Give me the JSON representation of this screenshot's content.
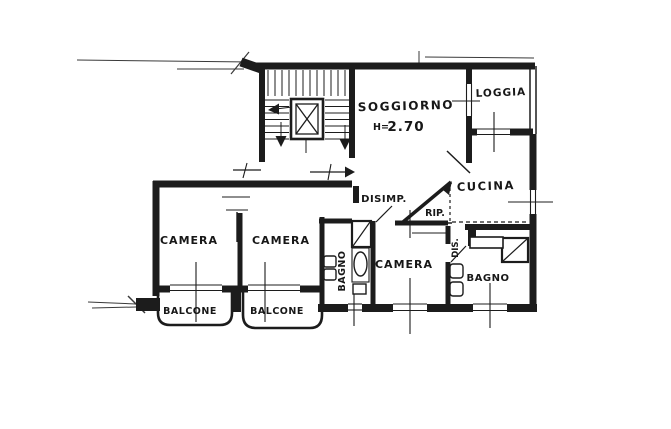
{
  "plan": {
    "type": "apartment-floor-plan",
    "ink_color": "#1c1c1c",
    "paper_color": "#ffffff"
  },
  "rooms": {
    "soggiorno": {
      "label": "SOGGIORNO",
      "height_prefix": "H=",
      "height_value": "2.70"
    },
    "loggia": {
      "label": "LOGGIA"
    },
    "cucina": {
      "label": "CUCINA"
    },
    "disimpegno": {
      "label": "DISIMP."
    },
    "ripostiglio": {
      "label": "RIP."
    },
    "camera_sx": {
      "label": "CAMERA"
    },
    "camera_centro": {
      "label": "CAMERA"
    },
    "camera_dx": {
      "label": "CAMERA"
    },
    "bagno_centro": {
      "label": "BAGNO"
    },
    "bagno_dx": {
      "label": "BAGNO"
    },
    "dis": {
      "label": "DIS."
    },
    "balcone_sx": {
      "label": "BALCONE"
    },
    "balcone_dx": {
      "label": "BALCONE"
    }
  }
}
